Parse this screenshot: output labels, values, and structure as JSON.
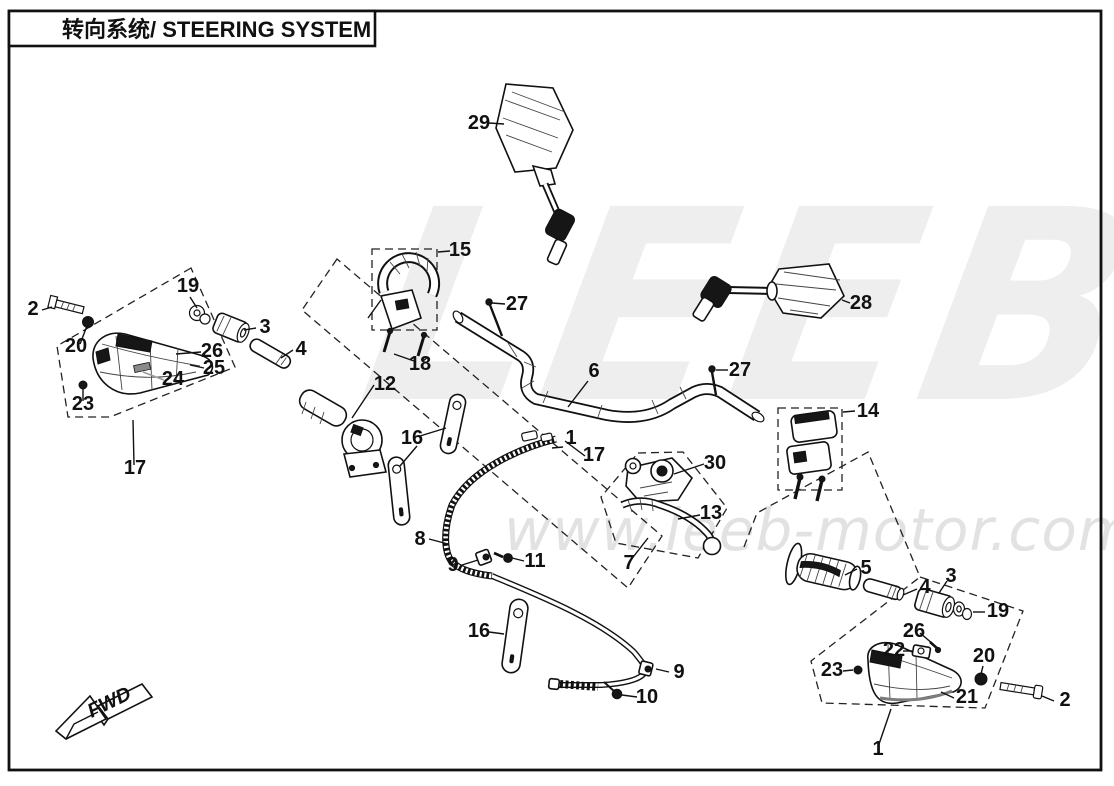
{
  "page": {
    "title": "转向系统/ STEERING SYSTEM"
  },
  "watermark": {
    "brand": "LEEB",
    "url": "www.leeb-motor.com"
  },
  "fwd": {
    "label": "FWD"
  },
  "callouts": {
    "c2a": {
      "n": "2"
    },
    "c19a": {
      "n": "19"
    },
    "c20a": {
      "n": "20"
    },
    "c3a": {
      "n": "3"
    },
    "c26a": {
      "n": "26"
    },
    "c25": {
      "n": "25"
    },
    "c4a": {
      "n": "4"
    },
    "c24": {
      "n": "24"
    },
    "c23a": {
      "n": "23"
    },
    "c17a": {
      "n": "17"
    },
    "c15": {
      "n": "15"
    },
    "c18": {
      "n": "18"
    },
    "c12": {
      "n": "12"
    },
    "c27a": {
      "n": "27"
    },
    "c6": {
      "n": "6"
    },
    "c27b": {
      "n": "27"
    },
    "c29": {
      "n": "29"
    },
    "c28": {
      "n": "28"
    },
    "c14": {
      "n": "14"
    },
    "c16a": {
      "n": "16"
    },
    "c8": {
      "n": "8"
    },
    "c9a": {
      "n": "9"
    },
    "c11": {
      "n": "11"
    },
    "c1a": {
      "n": "1"
    },
    "c17b": {
      "n": "17"
    },
    "c30": {
      "n": "30"
    },
    "c13": {
      "n": "13"
    },
    "c7": {
      "n": "7"
    },
    "c16b": {
      "n": "16"
    },
    "c9b": {
      "n": "9"
    },
    "c10": {
      "n": "10"
    },
    "c5": {
      "n": "5"
    },
    "c4b": {
      "n": "4"
    },
    "c3b": {
      "n": "3"
    },
    "c19b": {
      "n": "19"
    },
    "c26b": {
      "n": "26"
    },
    "c22": {
      "n": "22"
    },
    "c23b": {
      "n": "23"
    },
    "c20b": {
      "n": "20"
    },
    "c21": {
      "n": "21"
    },
    "c2b": {
      "n": "2"
    },
    "c1b": {
      "n": "1"
    }
  }
}
